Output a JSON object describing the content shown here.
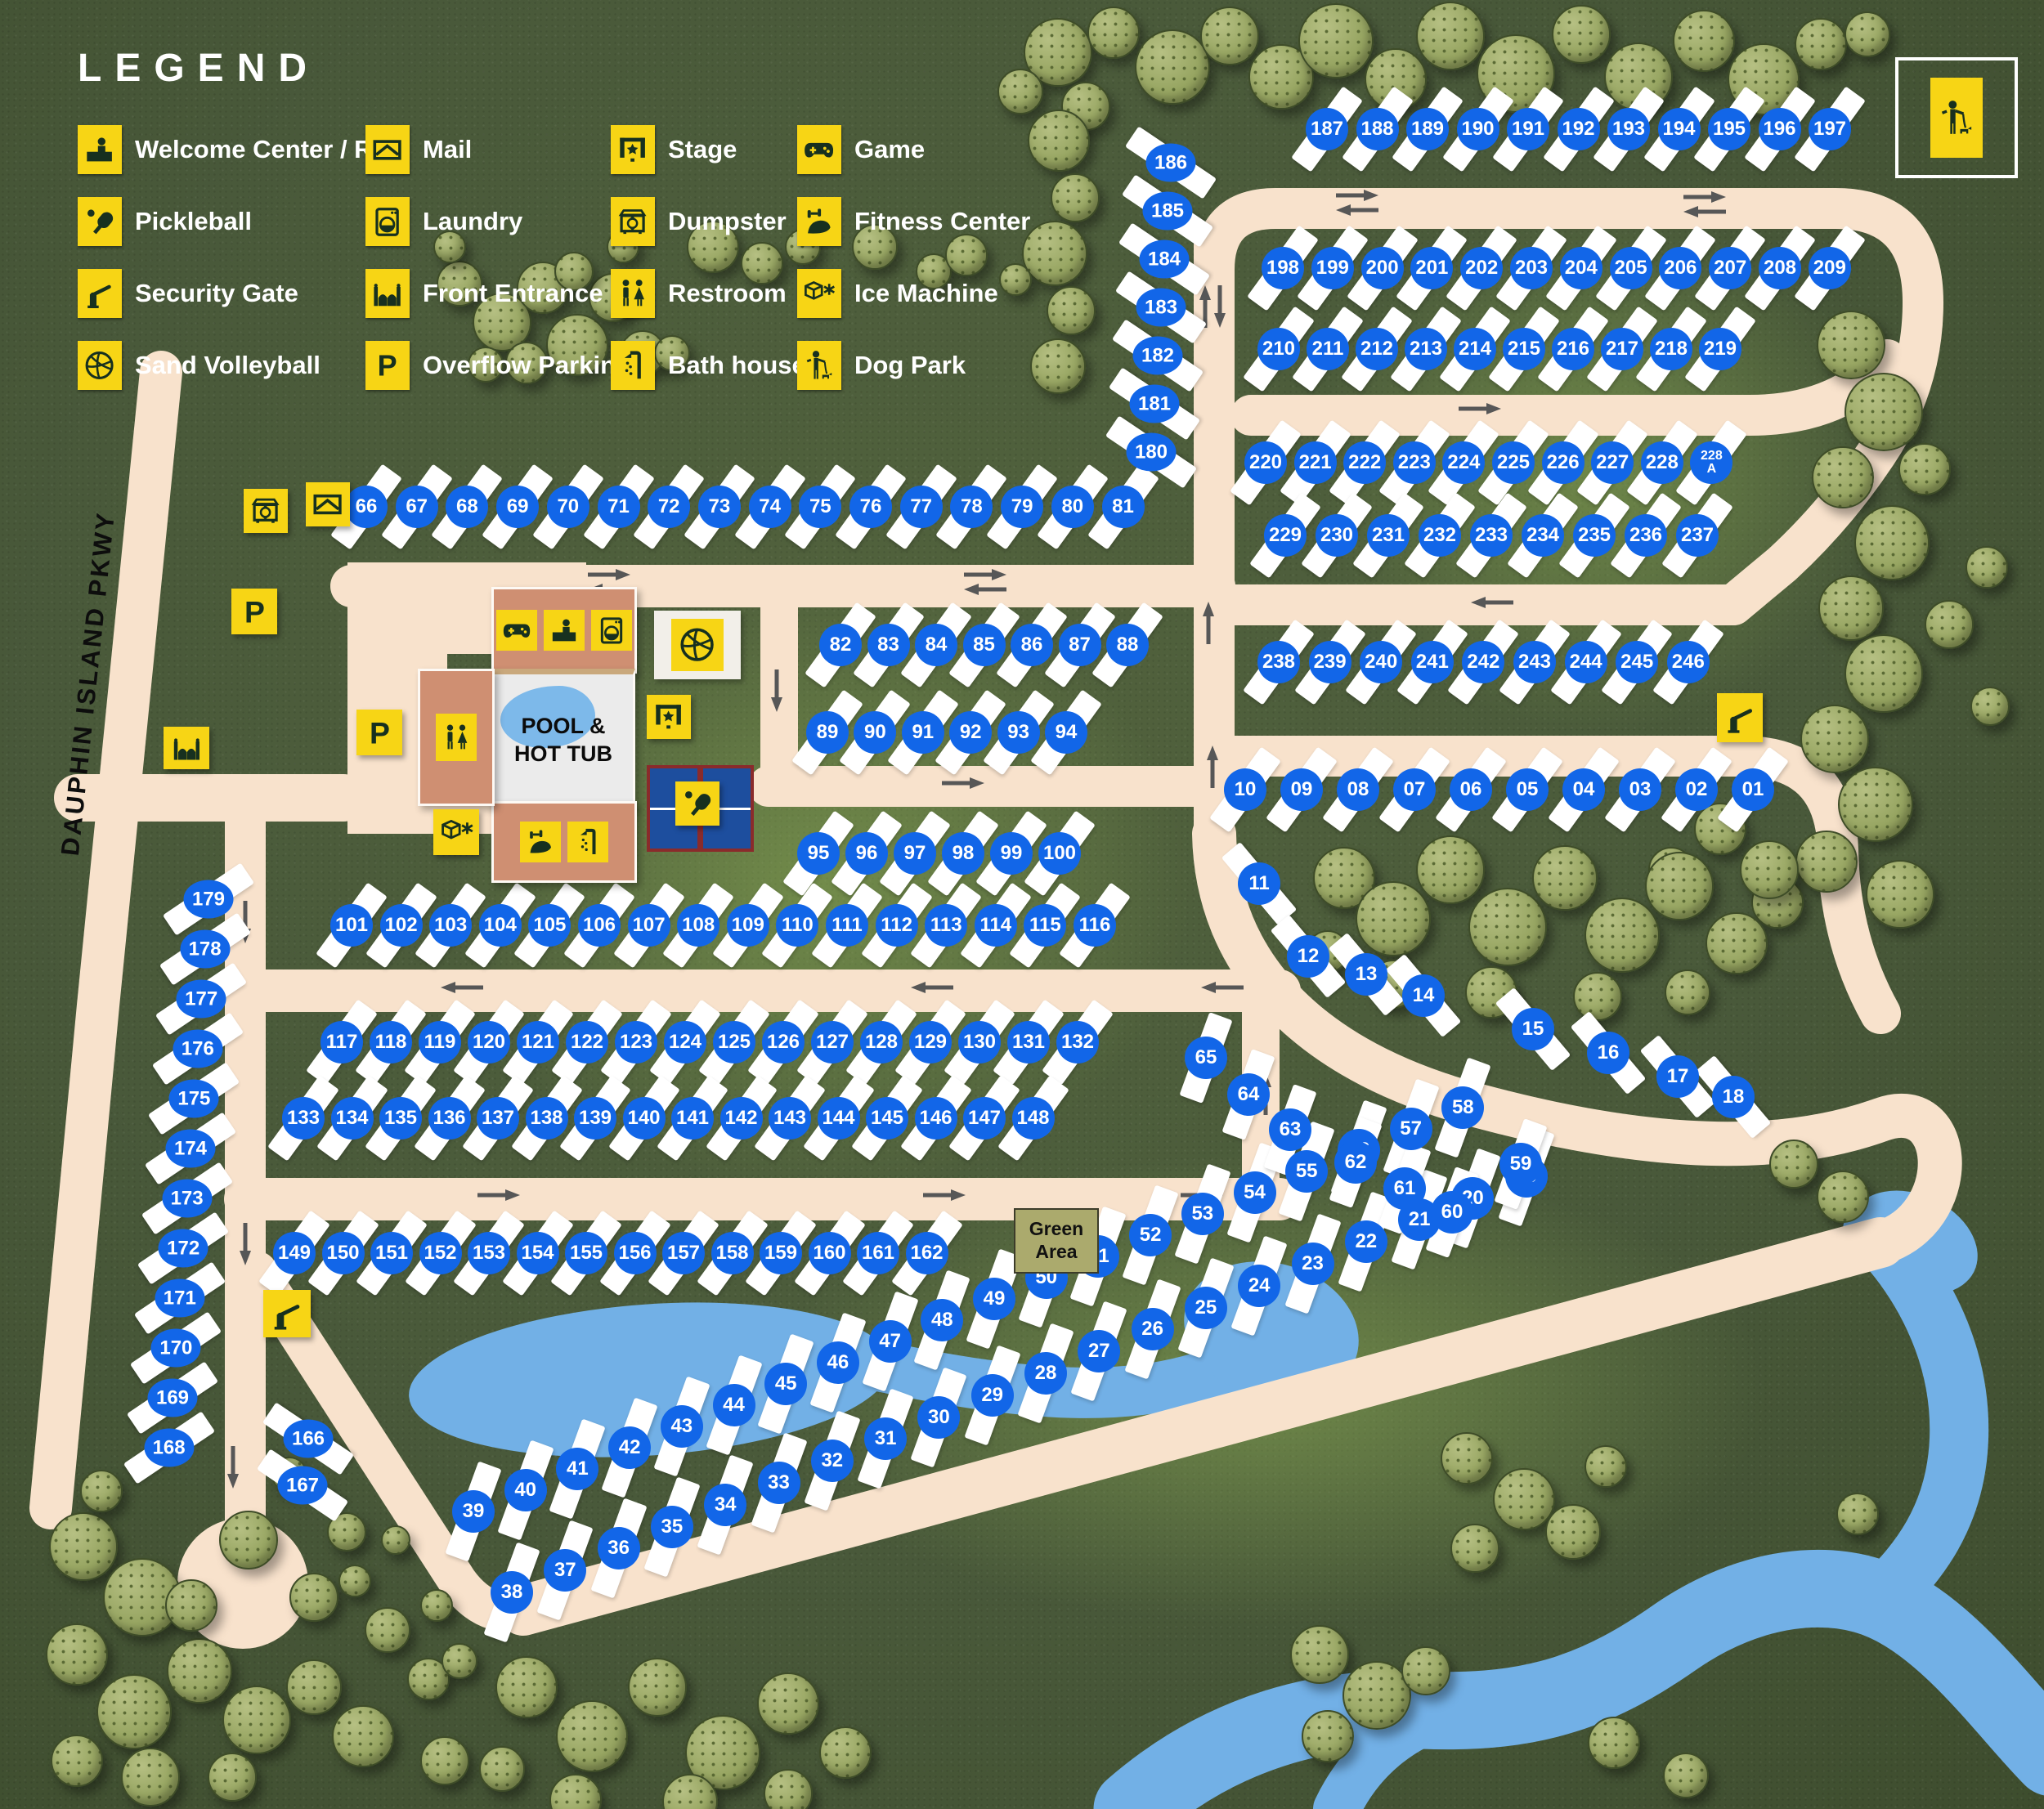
{
  "legend": {
    "title": "LEGEND",
    "items": [
      {
        "label": "Welcome Center / Rec",
        "icon": "welcome-center-icon"
      },
      {
        "label": "Pickleball",
        "icon": "pickleball-icon"
      },
      {
        "label": "Security Gate",
        "icon": "security-gate-icon"
      },
      {
        "label": "Sand Volleyball",
        "icon": "sand-volleyball-icon"
      },
      {
        "label": "Mail",
        "icon": "mail-icon"
      },
      {
        "label": "Laundry",
        "icon": "laundry-icon"
      },
      {
        "label": "Front Entrance",
        "icon": "front-entrance-icon"
      },
      {
        "label": "Overflow Parking",
        "icon": "overflow-parking-icon"
      },
      {
        "label": "Stage",
        "icon": "stage-icon"
      },
      {
        "label": "Dumpster",
        "icon": "dumpster-icon"
      },
      {
        "label": "Restroom",
        "icon": "restroom-icon"
      },
      {
        "label": "Bath house",
        "icon": "bath-house-icon"
      },
      {
        "label": "Game",
        "icon": "game-icon"
      },
      {
        "label": "Fitness Center",
        "icon": "fitness-center-icon"
      },
      {
        "label": "Ice Machine",
        "icon": "ice-machine-icon"
      },
      {
        "label": "Dog Park",
        "icon": "dog-park-icon"
      }
    ]
  },
  "map_labels": {
    "pool": "POOL &\nHOT TUB",
    "green_area": "Green\nArea",
    "parkway": "DAUPHIN ISLAND PKWY"
  },
  "sites": {
    "groups": [
      {
        "id": "r66",
        "labels": [
          "66",
          "67",
          "68",
          "69",
          "70",
          "71",
          "72",
          "73",
          "74",
          "75",
          "76",
          "77",
          "78",
          "79",
          "80",
          "81"
        ]
      },
      {
        "id": "r82",
        "labels": [
          "82",
          "83",
          "84",
          "85",
          "86",
          "87",
          "88"
        ]
      },
      {
        "id": "r89",
        "labels": [
          "89",
          "90",
          "91",
          "92",
          "93",
          "94"
        ]
      },
      {
        "id": "r95",
        "labels": [
          "95",
          "96",
          "97",
          "98",
          "99",
          "100"
        ]
      },
      {
        "id": "r101",
        "labels": [
          "101",
          "102",
          "103",
          "104",
          "105",
          "106",
          "107",
          "108",
          "109",
          "110",
          "111",
          "112",
          "113",
          "114",
          "115",
          "116"
        ]
      },
      {
        "id": "r117",
        "labels": [
          "117",
          "118",
          "119",
          "120",
          "121",
          "122",
          "123",
          "124",
          "125",
          "126",
          "127",
          "128",
          "129",
          "130",
          "131",
          "132"
        ]
      },
      {
        "id": "r133",
        "labels": [
          "133",
          "134",
          "135",
          "136",
          "137",
          "138",
          "139",
          "140",
          "141",
          "142",
          "143",
          "144",
          "145",
          "146",
          "147",
          "148"
        ]
      },
      {
        "id": "r149",
        "labels": [
          "149",
          "150",
          "151",
          "152",
          "153",
          "154",
          "155",
          "156",
          "157",
          "158",
          "159",
          "160",
          "161",
          "162"
        ]
      },
      {
        "id": "r187",
        "labels": [
          "187",
          "188",
          "189",
          "190",
          "191",
          "192",
          "193",
          "194",
          "195",
          "196",
          "197"
        ]
      },
      {
        "id": "r198",
        "labels": [
          "198",
          "199",
          "200",
          "201",
          "202",
          "203",
          "204",
          "205",
          "206",
          "207",
          "208",
          "209"
        ]
      },
      {
        "id": "r210",
        "labels": [
          "210",
          "211",
          "212",
          "213",
          "214",
          "215",
          "216",
          "217",
          "218",
          "219"
        ]
      },
      {
        "id": "r220",
        "labels": [
          "220",
          "221",
          "222",
          "223",
          "224",
          "225",
          "226",
          "227",
          "228",
          "228\nA"
        ]
      },
      {
        "id": "r229",
        "labels": [
          "229",
          "230",
          "231",
          "232",
          "233",
          "234",
          "235",
          "236",
          "237"
        ]
      },
      {
        "id": "r238",
        "labels": [
          "238",
          "239",
          "240",
          "241",
          "242",
          "243",
          "244",
          "245",
          "246"
        ]
      },
      {
        "id": "r01",
        "labels": [
          "10",
          "09",
          "08",
          "07",
          "06",
          "05",
          "04",
          "03",
          "02",
          "01"
        ]
      },
      {
        "id": "c186",
        "labels": [
          "186",
          "185",
          "184",
          "183",
          "182",
          "181",
          "180"
        ]
      },
      {
        "id": "c179",
        "labels": [
          "179",
          "178",
          "177",
          "176",
          "175",
          "174",
          "173",
          "172",
          "171",
          "170",
          "169",
          "168"
        ]
      },
      {
        "id": "s166",
        "labels": [
          "166",
          "167"
        ]
      },
      {
        "id": "d39",
        "labels": [
          "39",
          "40",
          "41",
          "42",
          "43",
          "44",
          "45",
          "46",
          "47",
          "48",
          "49",
          "50",
          "51",
          "52",
          "53",
          "54",
          "55",
          "56",
          "57",
          "58"
        ]
      },
      {
        "id": "d38",
        "labels": [
          "38",
          "37",
          "36",
          "35",
          "34",
          "33",
          "32",
          "31",
          "30",
          "29",
          "28",
          "27",
          "26",
          "25",
          "24",
          "23",
          "22",
          "21",
          "20",
          "19"
        ]
      },
      {
        "id": "s59",
        "labels": [
          "65",
          "64",
          "63",
          "62",
          "61",
          "60",
          "59"
        ]
      },
      {
        "id": "s11",
        "labels": [
          "11",
          "12",
          "13",
          "14",
          "15",
          "16",
          "17",
          "18"
        ]
      }
    ]
  },
  "map_icon_instances": [
    "dumpster-icon",
    "mail-icon",
    "overflow-parking-icon",
    "overflow-parking-icon",
    "front-entrance-icon",
    "security-gate-icon",
    "security-gate-icon",
    "stage-icon",
    "pickleball-icon",
    "ice-machine-icon"
  ],
  "colors": {
    "badge_blue": "#1266e8",
    "road_cream": "#f8e2cc",
    "icon_yellow": "#f7d515",
    "icon_dark": "#17301f",
    "water_blue": "#72b0e6",
    "building_salmon": "#cf8f72",
    "court_blue": "#1d4e9e",
    "court_border_maroon": "#8a2b2b",
    "green_area_bg": "#abaa6d",
    "background_green": "#49593a",
    "site_pad_white": "#ffffff",
    "arrow_gray": "#575757"
  }
}
